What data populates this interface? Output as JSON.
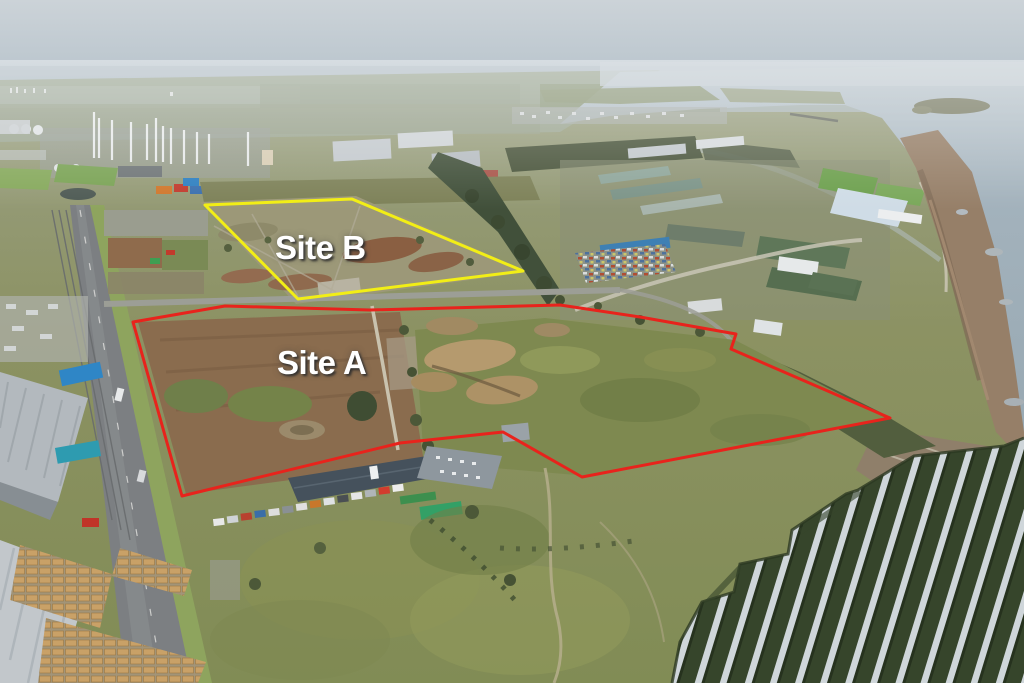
{
  "scene": {
    "type": "aerial drone photograph",
    "setting": "coastal brownfield development land beside a grey estuary, winter light",
    "elements": {
      "sky": "pale hazy blue-grey",
      "water": "estuary with distant shoreline, small headland island and breakwater",
      "left": "chemical works with white chimneys and tanks, playing field, container stacks, main road with rail sidings",
      "right": "industrial estate with green, blue and white warehouse roofs, scrap yard, rocky red-brown foreshore",
      "center": "two cleared brownfield plots with earth mounds, dirt, scrub grass and pale tracks",
      "bottom_left": "warehouses and timber yard with stacked pallets",
      "bottom_center": "long dark-roofed workshop with parked vans",
      "bottom_right": "solar farm with parallel rows of silver panels on dark green ground"
    }
  },
  "annotations": {
    "site_a": {
      "label": "Site A",
      "outline_color": "#e8231c",
      "label_color": "#ffffff"
    },
    "site_b": {
      "label": "Site B",
      "outline_color": "#f2ee16",
      "label_color": "#ffffff"
    }
  }
}
